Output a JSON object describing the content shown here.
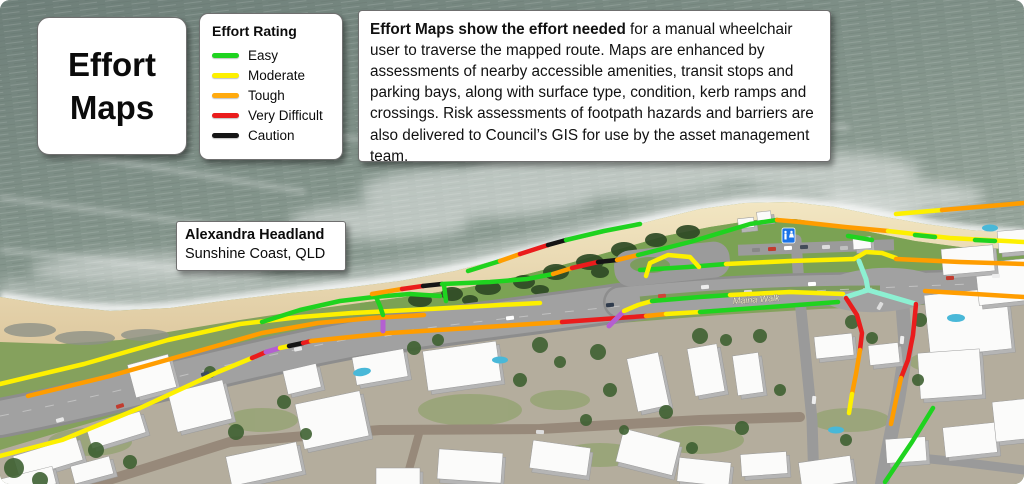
{
  "title": {
    "line1": "Effort",
    "line2": "Maps"
  },
  "legend": {
    "title": "Effort Rating",
    "items": [
      {
        "label": "Easy",
        "color": "#1fd31f"
      },
      {
        "label": "Moderate",
        "color": "#fdf000"
      },
      {
        "label": "Tough",
        "color": "#ffaa0e"
      },
      {
        "label": "Very Difficult",
        "color": "#ea1c1c"
      },
      {
        "label": "Caution",
        "color": "#151515"
      }
    ]
  },
  "description": {
    "bold": "Effort Maps show the effort needed",
    "rest": " for a manual wheelchair user to traverse the mapped route. Maps are enhanced by assessments of nearby accessible amenities, transit stops and parking bays, along with surface type, condition, kerb ramps and crossings. Risk assessments of footpath hazards and barriers are also delivered to Council’s GIS for use by the asset management team."
  },
  "location": {
    "name": "Alexandra Headland",
    "region": "Sunshine Coast, QLD"
  },
  "map": {
    "road_label": "Maina Walk",
    "effort_colors": {
      "easy": "#1fd31f",
      "moderate": "#fdf000",
      "tough": "#ff9d00",
      "very_difficult": "#ea1c1c",
      "caution": "#151515",
      "kerb_crossing": "#b45fd1",
      "signal_crossing": "#8df0d2"
    },
    "routes": [
      {
        "effort": "moderate",
        "width": 4.5,
        "points": [
          [
            0,
            456
          ],
          [
            62,
            440
          ],
          [
            140,
            408
          ],
          [
            218,
            372
          ],
          [
            252,
            358
          ]
        ]
      },
      {
        "effort": "very_difficult",
        "width": 4.5,
        "points": [
          [
            252,
            358
          ],
          [
            266,
            352
          ]
        ]
      },
      {
        "effort": "kerb_crossing",
        "width": 5,
        "points": [
          [
            266,
            352
          ],
          [
            280,
            348
          ]
        ]
      },
      {
        "effort": "moderate",
        "width": 4.5,
        "points": [
          [
            280,
            348
          ],
          [
            289,
            346
          ]
        ]
      },
      {
        "effort": "caution",
        "width": 4.5,
        "points": [
          [
            289,
            346
          ],
          [
            303,
            343
          ]
        ]
      },
      {
        "effort": "very_difficult",
        "width": 4.5,
        "points": [
          [
            303,
            343
          ],
          [
            311,
            341
          ]
        ]
      },
      {
        "effort": "tough",
        "width": 4.5,
        "points": [
          [
            311,
            341
          ],
          [
            390,
            333
          ],
          [
            470,
            328
          ],
          [
            562,
            322
          ]
        ]
      },
      {
        "effort": "very_difficult",
        "width": 4.5,
        "points": [
          [
            562,
            322
          ],
          [
            604,
            319
          ],
          [
            646,
            316
          ]
        ]
      },
      {
        "effort": "tough",
        "width": 4.5,
        "points": [
          [
            646,
            316
          ],
          [
            666,
            314
          ]
        ]
      },
      {
        "effort": "moderate",
        "width": 4.5,
        "points": [
          [
            666,
            314
          ],
          [
            700,
            312
          ]
        ]
      },
      {
        "effort": "easy",
        "width": 4.5,
        "points": [
          [
            700,
            312
          ],
          [
            770,
            307
          ],
          [
            838,
            302
          ]
        ]
      },
      {
        "effort": "kerb_crossing",
        "width": 5,
        "points": [
          [
            609,
            326
          ],
          [
            624,
            311
          ]
        ]
      },
      {
        "effort": "kerb_crossing",
        "width": 5,
        "points": [
          [
            383,
            317
          ],
          [
            383,
            331
          ]
        ]
      },
      {
        "effort": "moderate",
        "width": 4.5,
        "points": [
          [
            0,
            384
          ],
          [
            84,
            364
          ],
          [
            168,
            340
          ],
          [
            240,
            324
          ],
          [
            300,
            317
          ],
          [
            352,
            313
          ]
        ]
      },
      {
        "effort": "tough",
        "width": 4.5,
        "points": [
          [
            28,
            396
          ],
          [
            110,
            376
          ],
          [
            195,
            352
          ],
          [
            262,
            333
          ],
          [
            318,
            323
          ],
          [
            372,
            318
          ],
          [
            424,
            315
          ]
        ]
      },
      {
        "effort": "moderate",
        "width": 4.5,
        "points": [
          [
            352,
            313
          ],
          [
            430,
            309
          ],
          [
            500,
            305
          ],
          [
            540,
            303
          ]
        ]
      },
      {
        "effort": "moderate",
        "width": 4.5,
        "points": [
          [
            624,
            311
          ],
          [
            638,
            305
          ],
          [
            652,
            301
          ]
        ]
      },
      {
        "effort": "easy",
        "width": 4.5,
        "points": [
          [
            652,
            301
          ],
          [
            700,
            297
          ],
          [
            730,
            295
          ]
        ]
      },
      {
        "effort": "moderate",
        "width": 4.5,
        "points": [
          [
            730,
            295
          ],
          [
            790,
            292
          ],
          [
            843,
            294
          ]
        ]
      },
      {
        "effort": "easy",
        "width": 4.5,
        "points": [
          [
            640,
            270
          ],
          [
            688,
            267
          ],
          [
            726,
            264
          ]
        ]
      },
      {
        "effort": "moderate",
        "width": 4.5,
        "points": [
          [
            726,
            264
          ],
          [
            790,
            261
          ],
          [
            854,
            259
          ]
        ]
      },
      {
        "effort": "moderate",
        "width": 4.5,
        "points": [
          [
            854,
            259
          ],
          [
            866,
            252
          ],
          [
            882,
            253
          ],
          [
            896,
            258
          ]
        ]
      },
      {
        "effort": "tough",
        "width": 4.5,
        "points": [
          [
            896,
            259
          ],
          [
            960,
            262
          ],
          [
            1024,
            264
          ]
        ]
      },
      {
        "effort": "easy",
        "width": 4.5,
        "points": [
          [
            262,
            322
          ],
          [
            300,
            310
          ],
          [
            340,
            301
          ],
          [
            374,
            297
          ],
          [
            410,
            294
          ],
          [
            440,
            296
          ]
        ]
      },
      {
        "effort": "easy",
        "width": 4.5,
        "points": [
          [
            376,
            297
          ],
          [
            380,
            306
          ],
          [
            383,
            315
          ]
        ]
      },
      {
        "effort": "tough",
        "width": 4.5,
        "points": [
          [
            372,
            294
          ],
          [
            402,
            289
          ]
        ]
      },
      {
        "effort": "very_difficult",
        "width": 4.5,
        "points": [
          [
            402,
            289
          ],
          [
            423,
            286
          ]
        ]
      },
      {
        "effort": "caution",
        "width": 4.5,
        "points": [
          [
            423,
            286
          ],
          [
            442,
            284
          ]
        ]
      },
      {
        "effort": "easy",
        "width": 4.5,
        "points": [
          [
            442,
            284
          ],
          [
            490,
            282
          ],
          [
            527,
            279
          ],
          [
            553,
            274
          ]
        ]
      },
      {
        "effort": "tough",
        "width": 4.5,
        "points": [
          [
            553,
            274
          ],
          [
            572,
            268
          ]
        ]
      },
      {
        "effort": "very_difficult",
        "width": 4.5,
        "points": [
          [
            572,
            268
          ],
          [
            598,
            262
          ]
        ]
      },
      {
        "effort": "caution",
        "width": 4.5,
        "points": [
          [
            598,
            262
          ],
          [
            617,
            260
          ]
        ]
      },
      {
        "effort": "tough",
        "width": 4.5,
        "points": [
          [
            617,
            260
          ],
          [
            638,
            255
          ]
        ]
      },
      {
        "effort": "easy",
        "width": 4.5,
        "points": [
          [
            638,
            255
          ],
          [
            690,
            242
          ],
          [
            750,
            224
          ],
          [
            777,
            220
          ]
        ]
      },
      {
        "effort": "easy",
        "width": 4.5,
        "points": [
          [
            444,
            285
          ],
          [
            446,
            301
          ]
        ]
      },
      {
        "effort": "easy",
        "width": 4.5,
        "points": [
          [
            468,
            271
          ],
          [
            500,
            261
          ]
        ]
      },
      {
        "effort": "tough",
        "width": 4.5,
        "points": [
          [
            500,
            261
          ],
          [
            520,
            254
          ]
        ]
      },
      {
        "effort": "very_difficult",
        "width": 4.5,
        "points": [
          [
            520,
            254
          ],
          [
            548,
            245
          ]
        ]
      },
      {
        "effort": "caution",
        "width": 4.5,
        "points": [
          [
            548,
            245
          ],
          [
            566,
            240
          ]
        ]
      },
      {
        "effort": "easy",
        "width": 4.5,
        "points": [
          [
            566,
            240
          ],
          [
            604,
            231
          ],
          [
            640,
            224
          ]
        ]
      },
      {
        "effort": "tough",
        "width": 4.5,
        "points": [
          [
            777,
            220
          ],
          [
            800,
            222
          ],
          [
            845,
            227
          ],
          [
            888,
            231
          ]
        ]
      },
      {
        "effort": "easy",
        "width": 4.5,
        "points": [
          [
            848,
            236
          ],
          [
            872,
            240
          ]
        ]
      },
      {
        "effort": "moderate",
        "width": 4.5,
        "points": [
          [
            888,
            231
          ],
          [
            950,
            238
          ],
          [
            1024,
            242
          ]
        ]
      },
      {
        "effort": "easy",
        "width": 4.5,
        "points": [
          [
            915,
            235
          ],
          [
            935,
            237
          ]
        ]
      },
      {
        "effort": "easy",
        "width": 4.5,
        "points": [
          [
            975,
            240
          ],
          [
            995,
            241
          ]
        ]
      },
      {
        "effort": "moderate",
        "width": 4.5,
        "points": [
          [
            896,
            214
          ],
          [
            942,
            210
          ]
        ]
      },
      {
        "effort": "tough",
        "width": 4.5,
        "points": [
          [
            942,
            210
          ],
          [
            1024,
            203
          ]
        ]
      },
      {
        "effort": "moderate",
        "width": 4.5,
        "points": [
          [
            646,
            276
          ],
          [
            650,
            263
          ],
          [
            668,
            255
          ],
          [
            690,
            257
          ],
          [
            699,
            267
          ]
        ]
      },
      {
        "effort": "signal_crossing",
        "width": 5,
        "points": [
          [
            859,
            261
          ],
          [
            866,
            279
          ],
          [
            868,
            290
          ],
          [
            846,
            297
          ]
        ]
      },
      {
        "effort": "signal_crossing",
        "width": 5,
        "points": [
          [
            868,
            290
          ],
          [
            892,
            297
          ],
          [
            916,
            304
          ]
        ]
      },
      {
        "effort": "very_difficult",
        "width": 4.5,
        "points": [
          [
            846,
            298
          ],
          [
            857,
            315
          ],
          [
            862,
            333
          ],
          [
            860,
            350
          ]
        ]
      },
      {
        "effort": "tough",
        "width": 4.5,
        "points": [
          [
            860,
            350
          ],
          [
            856,
            374
          ],
          [
            852,
            394
          ]
        ]
      },
      {
        "effort": "moderate",
        "width": 4.5,
        "points": [
          [
            852,
            394
          ],
          [
            849,
            413
          ]
        ]
      },
      {
        "effort": "very_difficult",
        "width": 4.5,
        "points": [
          [
            916,
            304
          ],
          [
            913,
            335
          ],
          [
            908,
            360
          ],
          [
            901,
            378
          ]
        ]
      },
      {
        "effort": "tough",
        "width": 4.5,
        "points": [
          [
            901,
            378
          ],
          [
            896,
            400
          ],
          [
            891,
            424
          ]
        ]
      },
      {
        "effort": "easy",
        "width": 4.5,
        "points": [
          [
            933,
            408
          ],
          [
            912,
            442
          ],
          [
            885,
            482
          ]
        ]
      },
      {
        "effort": "tough",
        "width": 4.5,
        "points": [
          [
            925,
            291
          ],
          [
            975,
            294
          ],
          [
            1024,
            297
          ]
        ]
      }
    ]
  }
}
